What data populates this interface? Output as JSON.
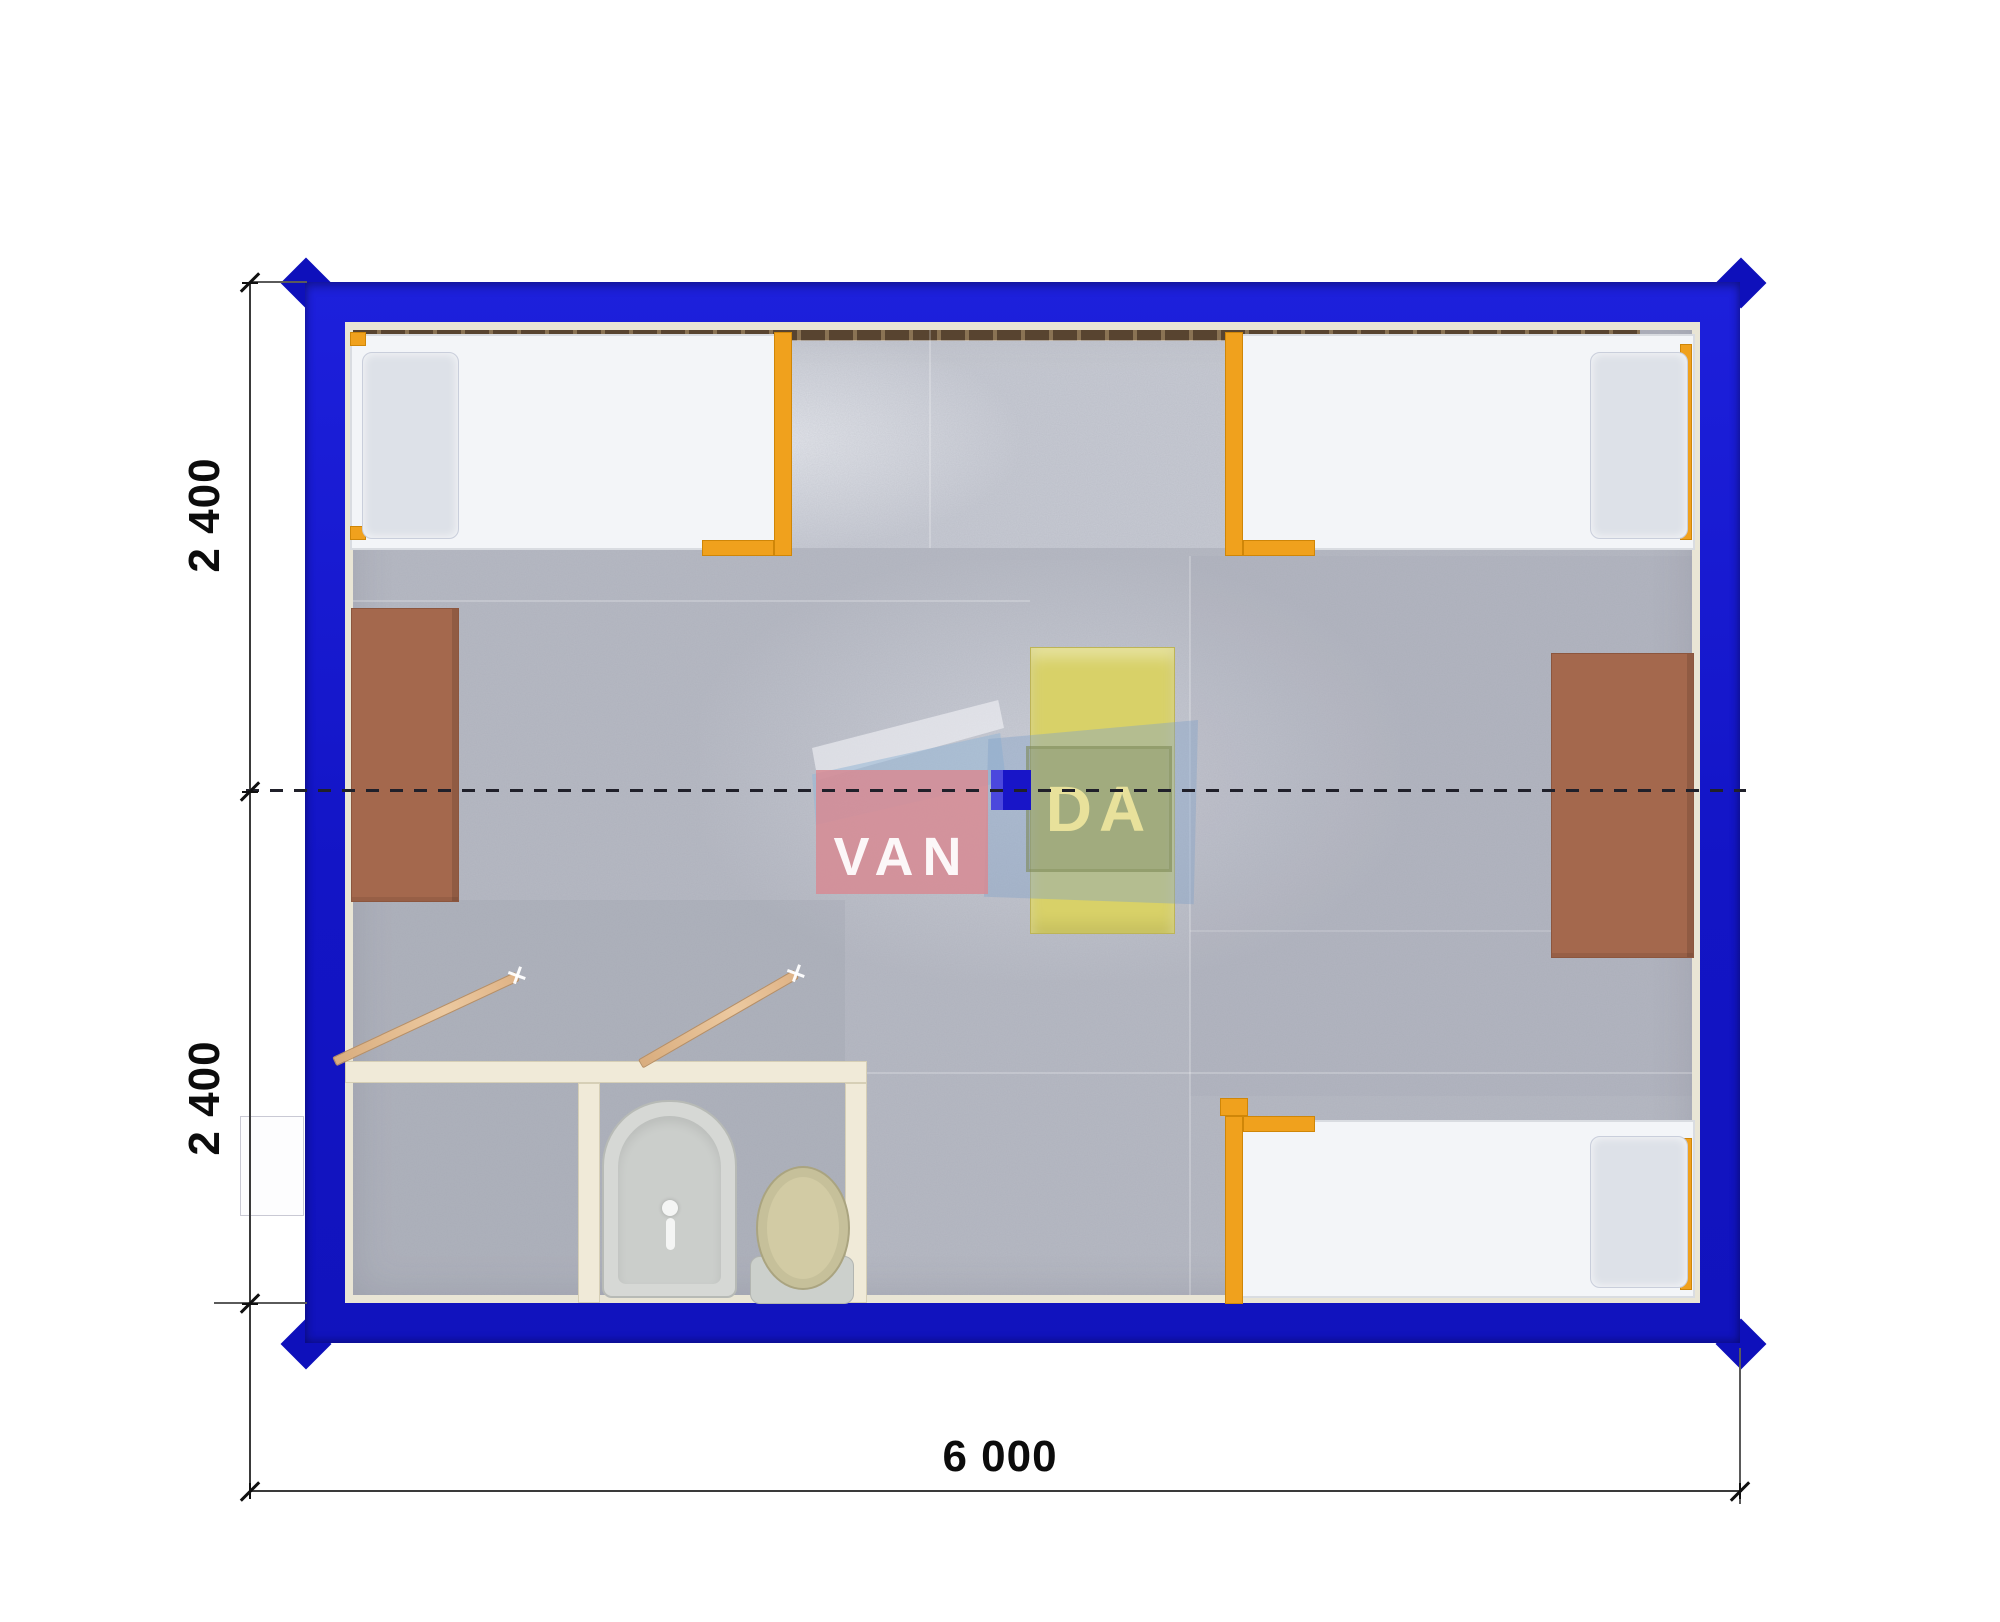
{
  "plan": {
    "type": "container-house-floor-plan",
    "watermark": {
      "left": "VAN",
      "right": "DA"
    },
    "dimensions": {
      "bottom_width": "6 000",
      "left_top": "2 400",
      "left_bottom": "2 400"
    },
    "colors": {
      "container_wall_blue": "#1517cd",
      "bed_frame_orange": "#f0a11d",
      "desk_brown": "#a4684d",
      "table_yellow": "#d8d168",
      "partition_cream": "#f0ead8",
      "floor_carpet_gray": "#b6b9c3",
      "watermark_pink": "#d98a94",
      "watermark_blue": "#82a2c8",
      "watermark_letters": "#e8e19b",
      "dimension_text": "#0c0c0c"
    },
    "furniture": [
      {
        "name": "bed-top-left"
      },
      {
        "name": "bed-top-right"
      },
      {
        "name": "bed-bottom-right"
      },
      {
        "name": "desk-left"
      },
      {
        "name": "desk-right"
      },
      {
        "name": "table-center"
      },
      {
        "name": "sink"
      },
      {
        "name": "toilet"
      },
      {
        "name": "door-bathroom-left"
      },
      {
        "name": "door-bathroom-right"
      }
    ]
  }
}
